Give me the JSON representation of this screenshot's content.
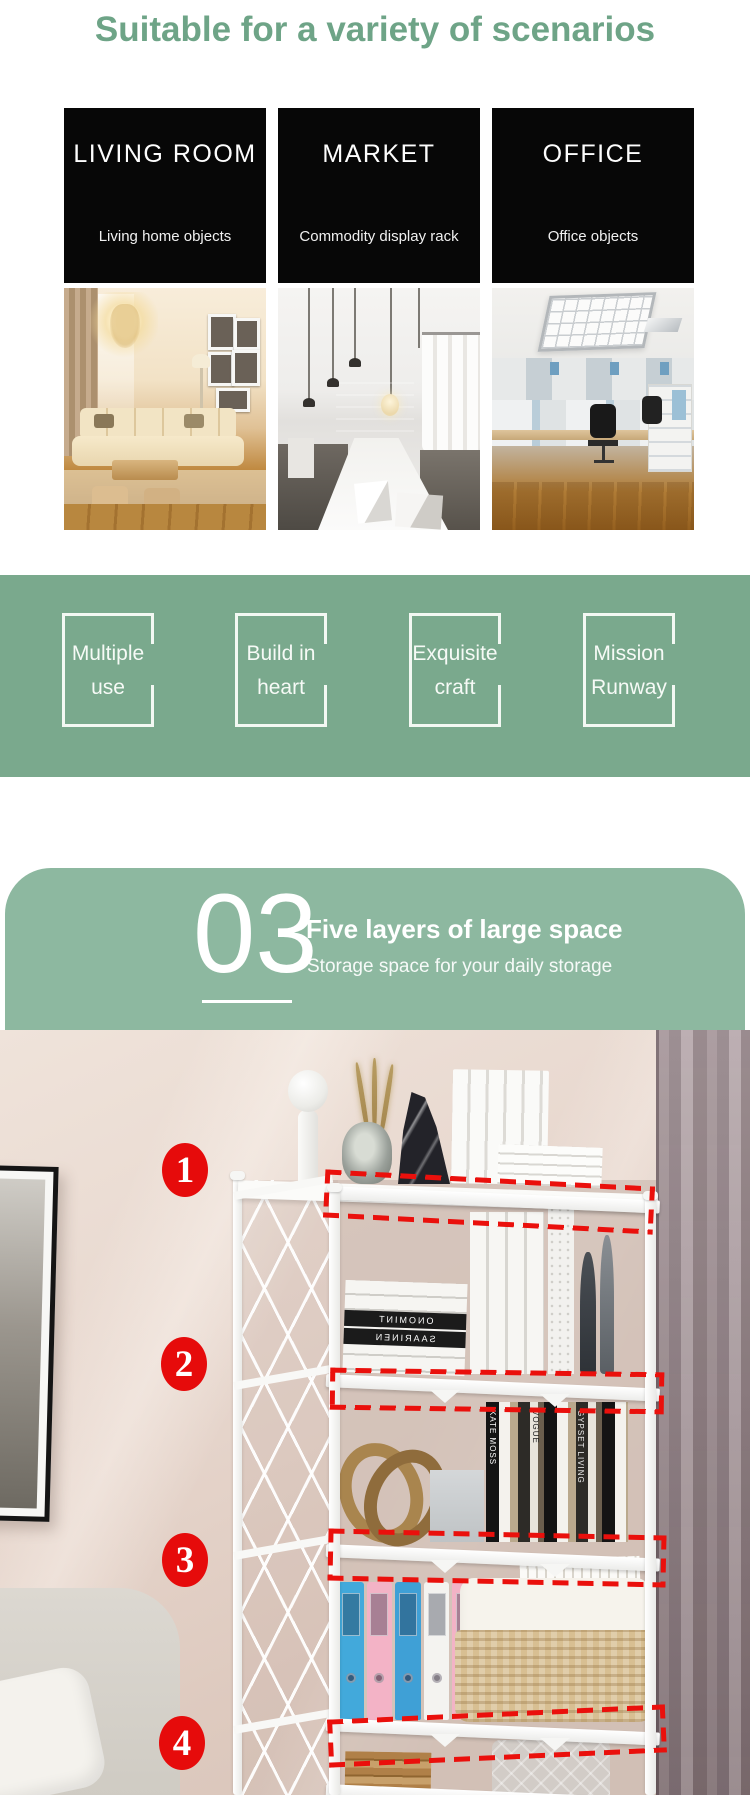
{
  "header": {
    "title": "Suitable for a variety of scenarios"
  },
  "scenarios": [
    {
      "title": "LIVING ROOM",
      "subtitle": "Living home objects"
    },
    {
      "title": "MARKET",
      "subtitle": "Commodity display rack"
    },
    {
      "title": "OFFICE",
      "subtitle": "Office objects"
    }
  ],
  "features": [
    {
      "line1": "Multiple",
      "line2": "use"
    },
    {
      "line1": "Build in",
      "line2": "heart"
    },
    {
      "line1": "Exquisite",
      "line2": "craft"
    },
    {
      "line1": "Mission",
      "line2": "Runway"
    }
  ],
  "section": {
    "number": "03",
    "title": "Five layers of large space",
    "subtitle": "Storage space for your daily storage"
  },
  "markers": [
    "1",
    "2",
    "3",
    "4"
  ],
  "photo_text": {
    "spine1": "ONOMINT",
    "spine2": "SAARINEN",
    "mag1": "KATE MOSS",
    "mag2": "VOGUE",
    "mag3": "GYPSET LIVING"
  },
  "colors": {
    "heading_green": "#6ea487",
    "band_green": "#7aa98d",
    "section_green": "#8db8a0",
    "panel_black": "#070707",
    "marker_red": "#e60b0b",
    "dash_red": "#ea100c"
  }
}
